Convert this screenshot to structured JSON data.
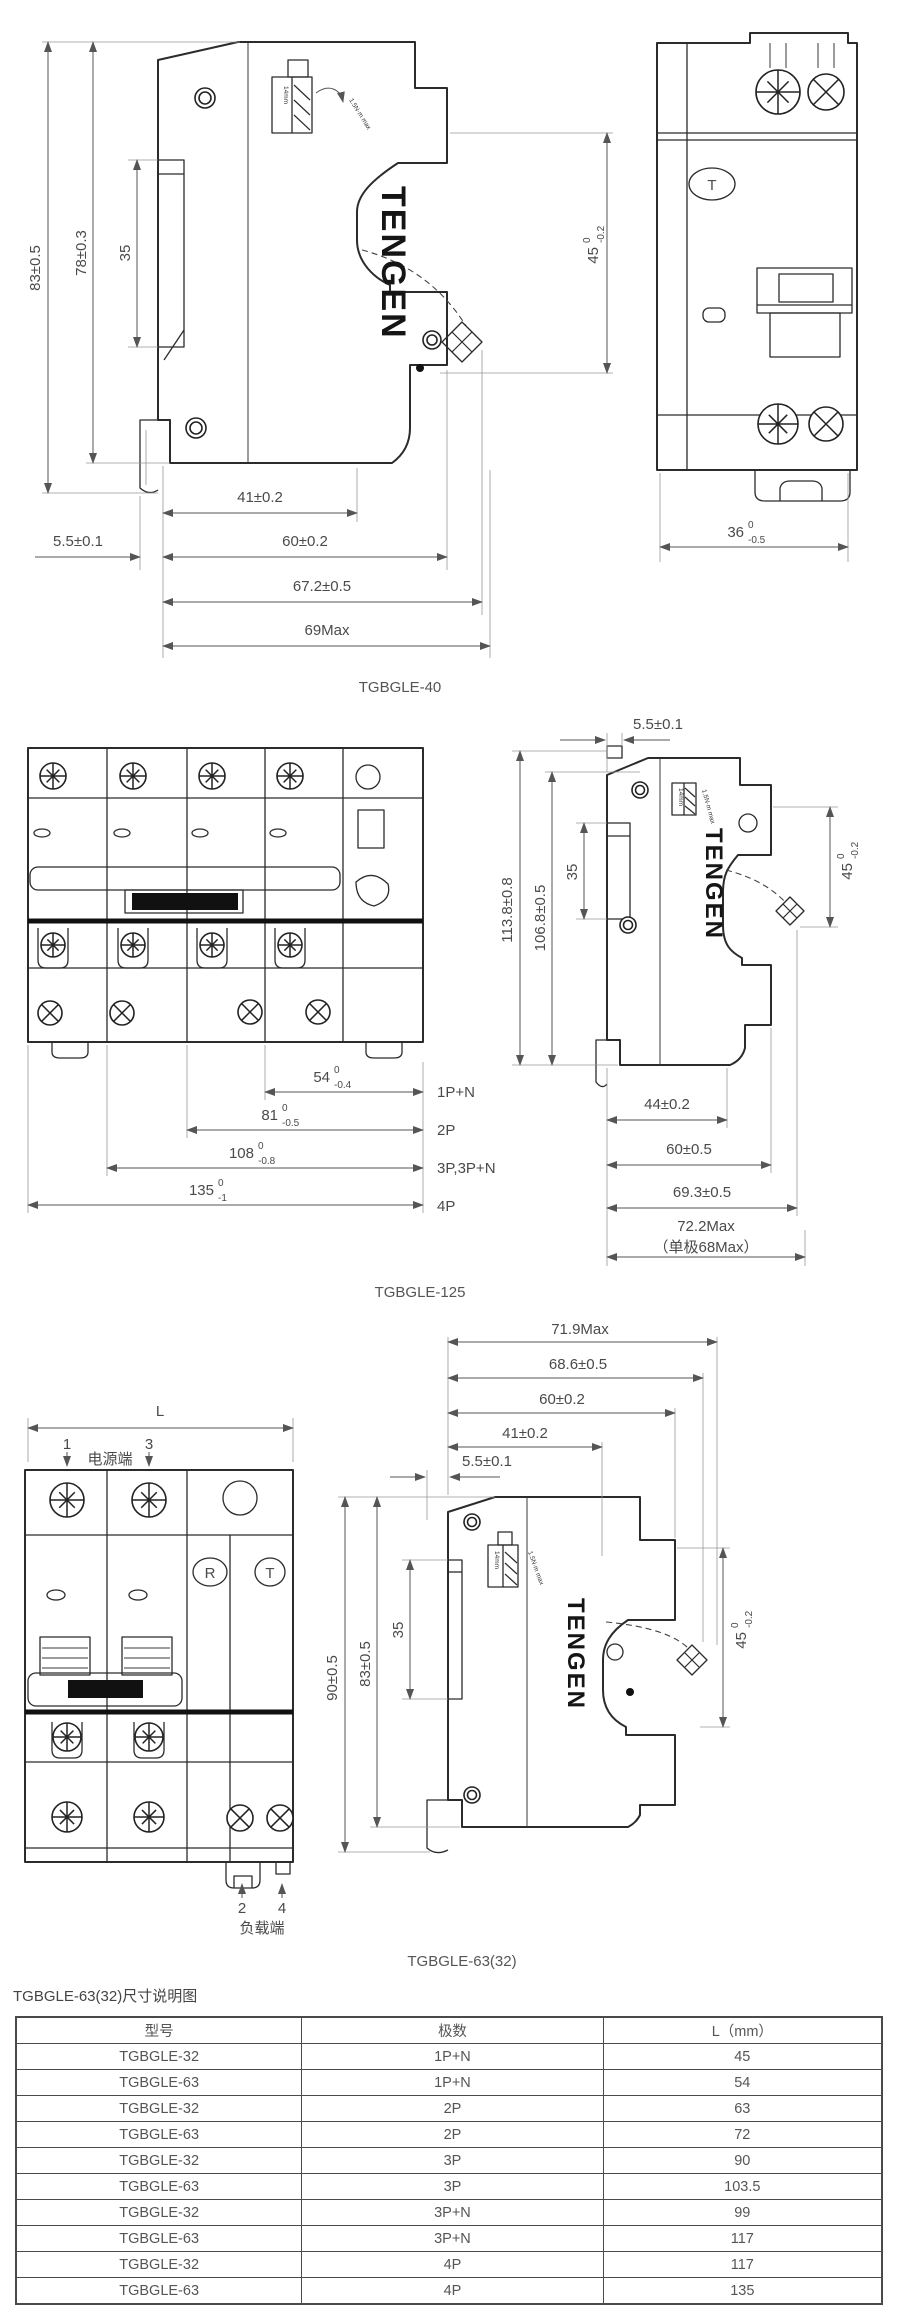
{
  "brand": "TENGEN",
  "captions": {
    "s1": "TGBGLE-40",
    "s2": "TGBGLE-125",
    "s3": "TGBGLE-63(32)"
  },
  "s1": {
    "dim_83": "83±0.5",
    "dim_78": "78±0.3",
    "dim_35": "35",
    "dim_41": "41±0.2",
    "dim_55": "5.5±0.1",
    "dim_60": "60±0.2",
    "dim_672": "67.2±0.5",
    "dim_69": "69Max",
    "dim_45": {
      "v": "45",
      "sup": "0",
      "sub": "-0.2"
    },
    "detail_14mm": "14mm",
    "detail_torque": "1.5N·m max",
    "front": {
      "test_button": "T",
      "dim_36": {
        "v": "36",
        "sup": "0",
        "sub": "-0.5"
      }
    }
  },
  "s2": {
    "dim_55": "5.5±0.1",
    "dim_1138": "113.8±0.8",
    "dim_1068": "106.8±0.5",
    "dim_35": "35",
    "dim_45": {
      "v": "45",
      "sup": "0",
      "sub": "-0.2"
    },
    "dim_44": "44±0.2",
    "dim_60": "60±0.5",
    "dim_693": "69.3±0.5",
    "dim_722": "72.2Max",
    "dim_68": "（单极68Max）",
    "widths": [
      {
        "v": "54",
        "sup": "0",
        "sub": "-0.4",
        "pole": "1P+N"
      },
      {
        "v": "81",
        "sup": "0",
        "sub": "-0.5",
        "pole": "2P"
      },
      {
        "v": "108",
        "sup": "0",
        "sub": "-0.8",
        "pole": "3P,3P+N"
      },
      {
        "v": "135",
        "sup": "0",
        "sub": "-1",
        "pole": "4P"
      }
    ],
    "detail_14mm": "14mm",
    "detail_torque": "1.5N·m max"
  },
  "s3": {
    "dim_L": "L",
    "terminal_1": "1",
    "terminal_3": "3",
    "line_end": "电源端",
    "terminal_2": "2",
    "terminal_4": "4",
    "load_end": "负载端",
    "btn_r": "R",
    "btn_t": "T",
    "dim_719": "71.9Max",
    "dim_686": "68.6±0.5",
    "dim_60": "60±0.2",
    "dim_41": "41±0.2",
    "dim_55": "5.5±0.1",
    "dim_90": "90±0.5",
    "dim_83": "83±0.5",
    "dim_35": "35",
    "dim_45": {
      "v": "45",
      "sup": "0",
      "sub": "-0.2"
    },
    "detail_14mm": "14mm",
    "detail_torque": "1.5N·m max"
  },
  "table": {
    "heading": "TGBGLE-63(32)尺寸说明图",
    "headers": [
      "型号",
      "极数",
      "L（mm）"
    ],
    "rows": [
      {
        "model": "TGBGLE-32",
        "poles": "1P+N",
        "l": "45"
      },
      {
        "model": "TGBGLE-63",
        "poles": "1P+N",
        "l": "54"
      },
      {
        "model": "TGBGLE-32",
        "poles": "2P",
        "l": "63"
      },
      {
        "model": "TGBGLE-63",
        "poles": "2P",
        "l": "72"
      },
      {
        "model": "TGBGLE-32",
        "poles": "3P",
        "l": "90"
      },
      {
        "model": "TGBGLE-63",
        "poles": "3P",
        "l": "103.5"
      },
      {
        "model": "TGBGLE-32",
        "poles": "3P+N",
        "l": "99"
      },
      {
        "model": "TGBGLE-63",
        "poles": "3P+N",
        "l": "117"
      },
      {
        "model": "TGBGLE-32",
        "poles": "4P",
        "l": "117"
      },
      {
        "model": "TGBGLE-63",
        "poles": "4P",
        "l": "135"
      }
    ]
  }
}
